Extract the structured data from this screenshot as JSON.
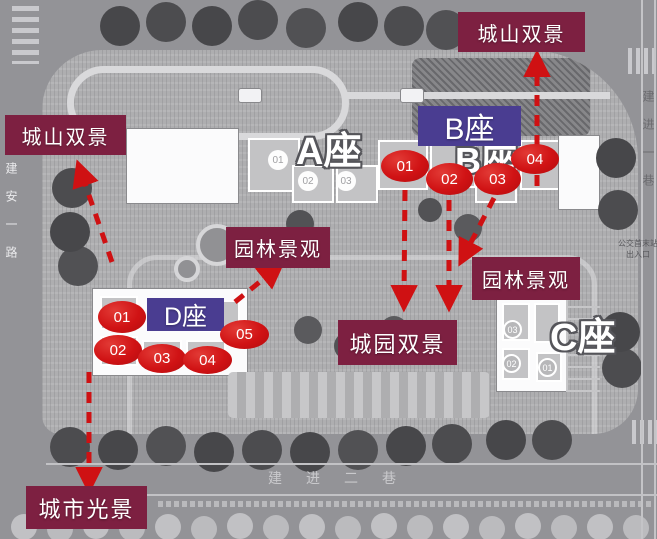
{
  "callouts": {
    "top_right": "城山双景",
    "left": "城山双景",
    "garden_center": "园林景观",
    "garden_right": "园林景观",
    "city_garden": "城园双景",
    "city_lights": "城市光景"
  },
  "buildings": {
    "a_label": "A座",
    "b_label": "B座",
    "c_label": "C座",
    "b_badge": "B座",
    "d_badge": "D座"
  },
  "markers": {
    "b": [
      "01",
      "02",
      "03",
      "04"
    ],
    "d": [
      "01",
      "02",
      "03",
      "04",
      "05"
    ]
  },
  "units": {
    "a": [
      "01",
      "02",
      "03"
    ],
    "c": [
      "03",
      "02",
      "01"
    ]
  },
  "roads": {
    "left": "建安一路",
    "right": "建进一巷",
    "bottom": "建进二巷"
  },
  "bus_stop": {
    "line1": "公交首末站",
    "line2": "出入口"
  },
  "colors": {
    "callout_bg": "#7d2041",
    "badge_bg": "#4a3d91",
    "marker_red": "#d01214",
    "arrow_red": "#cf1113"
  }
}
